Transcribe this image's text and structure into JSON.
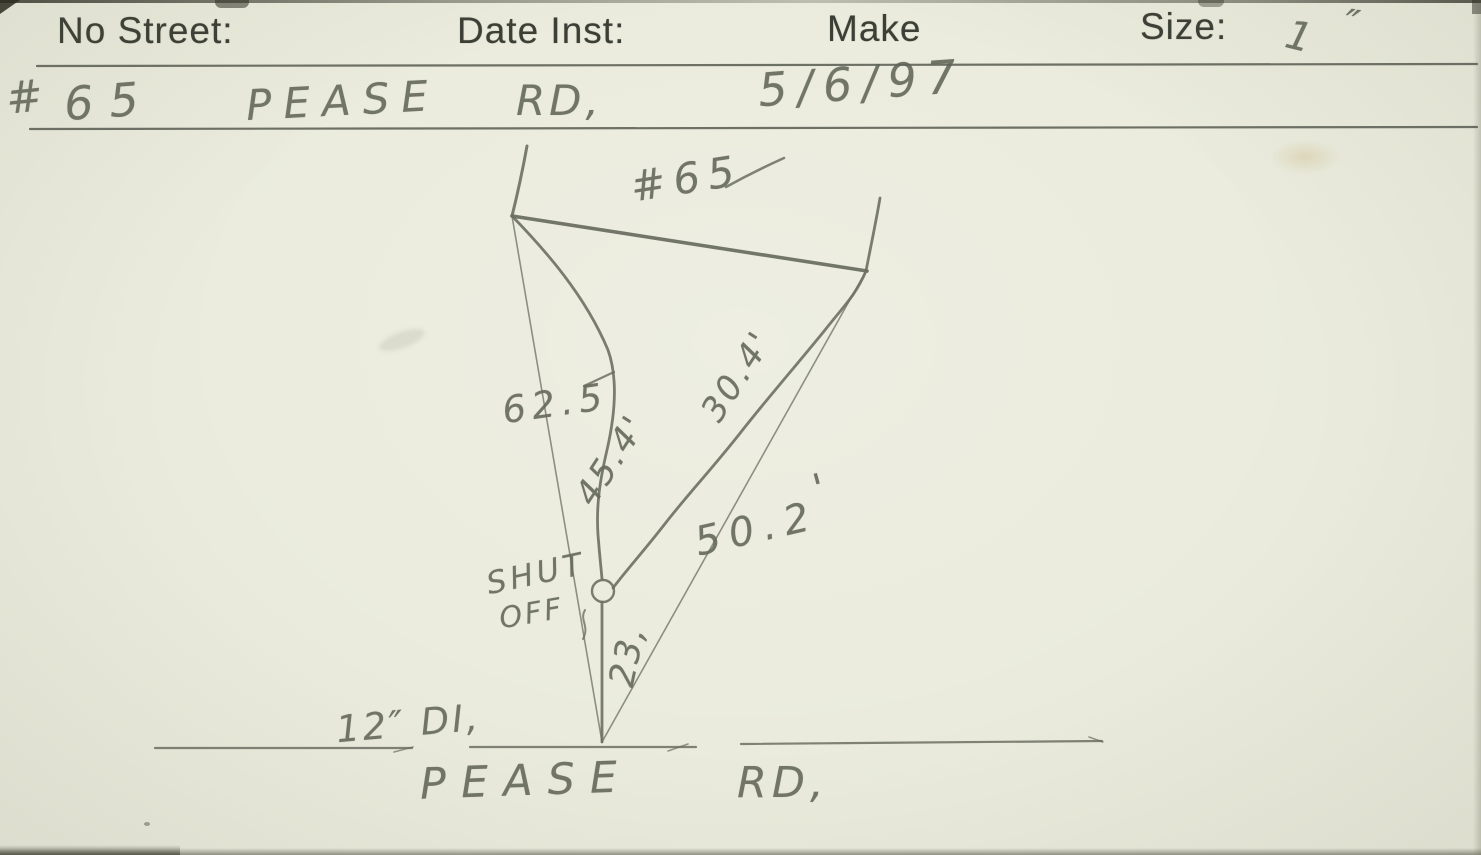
{
  "form": {
    "no_street_label": "No Street:",
    "date_inst_label": "Date Inst:",
    "make_label": "Make",
    "size_label": "Size:",
    "size_value": "1",
    "size_unit": "″",
    "street_hash": "#",
    "street_number": "65",
    "street_name": "PEASE",
    "street_suffix": "RD,",
    "date_value": "5/6/97"
  },
  "sketch": {
    "house_number": "#65",
    "tie_left": "62.5",
    "service_left": "45.4'",
    "service_right": "30.4'",
    "tie_right": "50.2",
    "tie_right_prime": "'",
    "curb_to_main": "23,",
    "shutoff_word1": "SHUT",
    "shutoff_word2": "OFF",
    "main_size": "12″ DI,",
    "road_name": "PEASE",
    "road_suffix": "RD,"
  },
  "colors": {
    "paper": "#eaebdc",
    "pencil": "#6b6f62",
    "print": "#3b3f35"
  }
}
